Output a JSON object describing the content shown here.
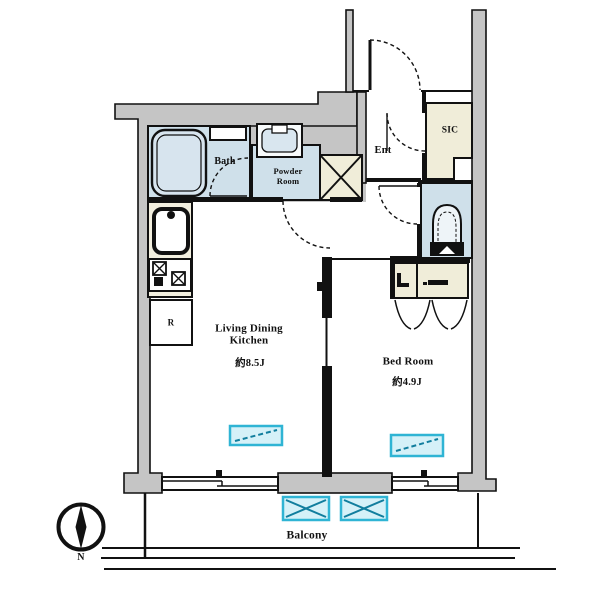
{
  "plan": {
    "ldk": {
      "line1": "Living Dining",
      "line2": "Kitchen",
      "size": "約8.5J"
    },
    "bedroom": {
      "line1": "Bed Room",
      "size": "約4.9J"
    },
    "bath": {
      "label": "Bath"
    },
    "powder": {
      "line1": "Powder",
      "line2": "Room"
    },
    "entrance": {
      "label": "Ent"
    },
    "sic": {
      "label": "SIC"
    },
    "refrigerator": {
      "label": "R"
    },
    "balcony": {
      "label": "Balcony"
    },
    "compass": {
      "north": "N"
    }
  },
  "colors": {
    "wall_gray": "#c5c5c5",
    "wet_area_blue": "#cfe0ea",
    "tub_blue": "#d7e4ee",
    "storage_beige": "#f0edd9",
    "window_cyan": "#2fb4d4",
    "window_cyan_fill": "#d5f1f8",
    "line_black": "#111111"
  }
}
